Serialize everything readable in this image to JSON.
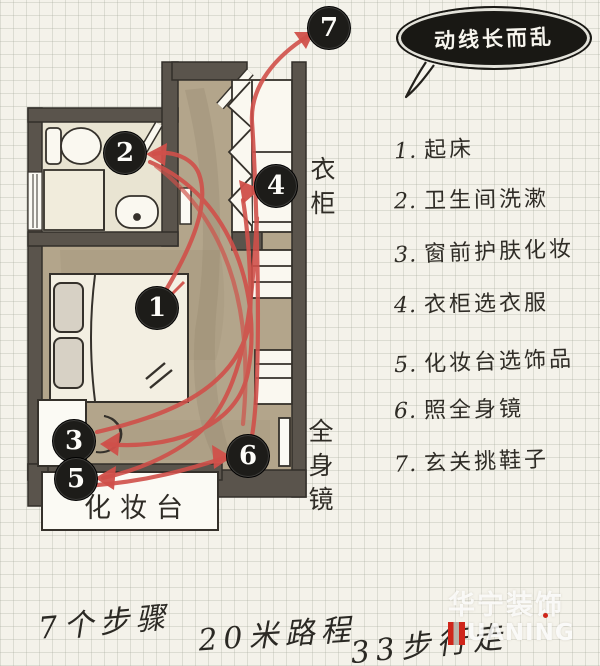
{
  "bubble": {
    "text": "动线长而乱"
  },
  "plan": {
    "markers": [
      "1",
      "2",
      "3",
      "4",
      "5",
      "6",
      "7"
    ],
    "labels": {
      "wardrobe": "衣柜",
      "full_mirror": "全身镜",
      "dresser": "化妆台"
    }
  },
  "legend": {
    "items": [
      {
        "num": "1.",
        "label": "起床"
      },
      {
        "num": "2.",
        "label": "卫生间洗漱"
      },
      {
        "num": "3.",
        "label": "窗前护肤化妆"
      },
      {
        "num": "4.",
        "label": "衣柜选衣服"
      },
      {
        "num": "5.",
        "label": "化妆台选饰品"
      },
      {
        "num": "6.",
        "label": "照全身镜"
      },
      {
        "num": "7.",
        "label": "玄关挑鞋子"
      }
    ]
  },
  "stats": {
    "steps": "7个步骤",
    "distance": "20米路程",
    "paces": "33步行走"
  },
  "watermark": {
    "brand": "华宁装饰",
    "latin": "UANING"
  },
  "colors": {
    "paper": "#f4f2ea",
    "wall": "#5a544c",
    "floor_tan": "#b3a58b",
    "bath_floor": "#e9e4d2",
    "furniture_white": "#faf8f0",
    "path_red": "#d0504a",
    "marker_bg": "#1d1c19",
    "ink": "#2f2c26"
  }
}
